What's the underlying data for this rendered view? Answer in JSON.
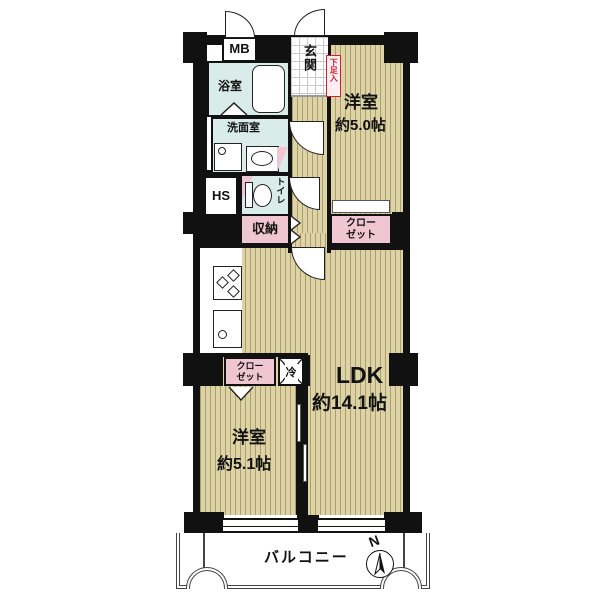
{
  "plan": {
    "mb": "MB",
    "entrance": "玄関",
    "shoe_box": "下足入",
    "bathroom": "浴室",
    "washroom": "洗面室",
    "hs": "HS",
    "toilet": "トイレ",
    "storage": "収納",
    "closet_main_line1": "クロー",
    "closet_main_line2": "ゼット",
    "closet_sub_line1": "クロー",
    "closet_sub_line2": "ゼット",
    "bedroom1_name": "洋室",
    "bedroom1_size": "約5.0帖",
    "bedroom2_name": "洋室",
    "bedroom2_size": "約5.1帖",
    "ldk_name": "LDK",
    "ldk_size": "約14.1帖",
    "fridge": "冷",
    "balcony": "バルコニー",
    "compass_n": "N"
  },
  "colors": {
    "wall": "#111111",
    "floor_base": "#ddd3a4",
    "floor_stripe": "#ab9e70",
    "wet_area": "#d9ece9",
    "closet_pink": "#f0c6d3",
    "shoe_box_red": "#cc2233"
  }
}
